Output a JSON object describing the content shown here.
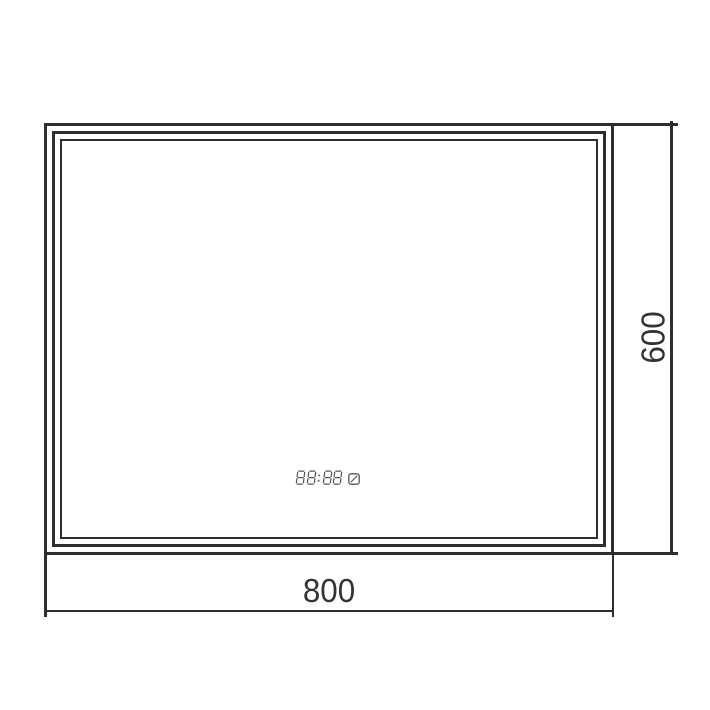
{
  "drawing": {
    "width_label": "800",
    "height_label": "600",
    "clock": {
      "value": "88:88",
      "icon": "touch-sensor-icon"
    },
    "colors": {
      "line": "#2d2d2d",
      "dimension_text": "#333333",
      "clock": "#555555"
    }
  }
}
